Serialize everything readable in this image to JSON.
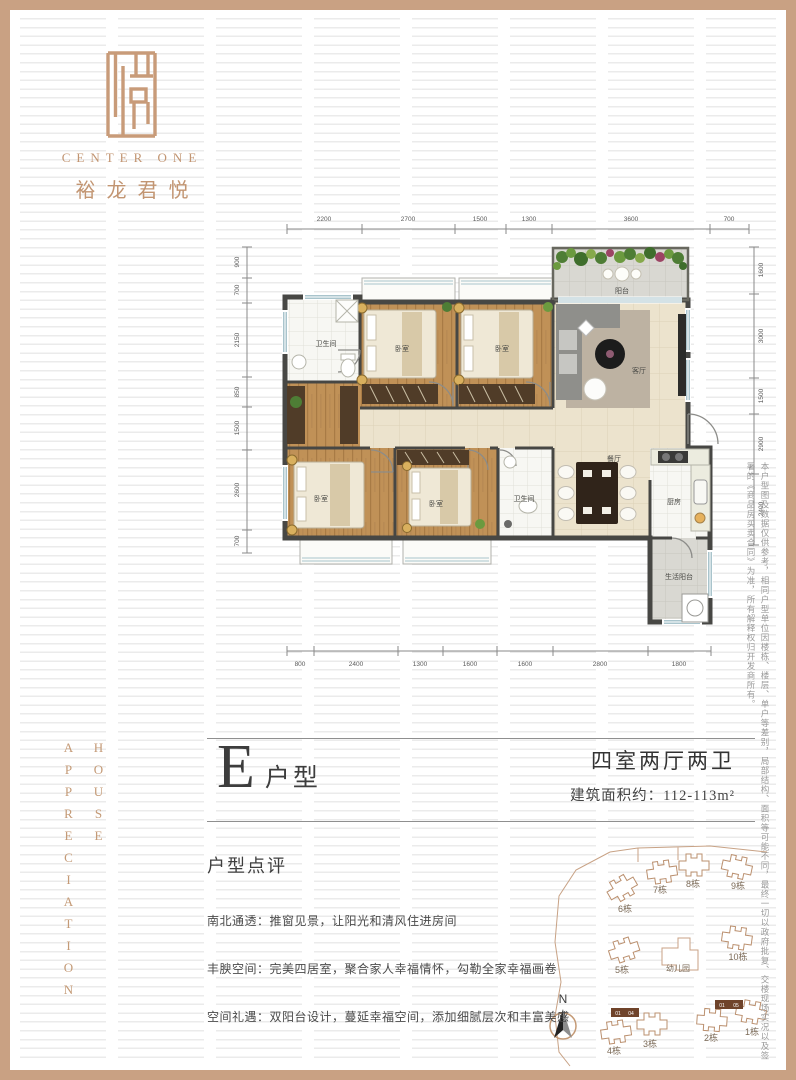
{
  "brand": {
    "name_en": "CENTER ONE",
    "name_cn": "裕龙君悦"
  },
  "side_left": {
    "word1": "HOUSE",
    "word2": "APPRECIATION"
  },
  "side_right": {
    "disclaimer": "本户型图及数据仅供参考，相同户型单位因楼栋、楼层、单户等差别，局部结构、面积等可能不同，最终一切以政府批复、交楼现场实况以及签署的《商品房买卖合同》为准，所有解释权归开发商所有。"
  },
  "unit": {
    "letter": "E",
    "suffix": "户型",
    "config": "四室两厅两卫",
    "area": "建筑面积约：112-113m²"
  },
  "review": {
    "heading": "户型点评",
    "items": [
      "南北通透：推窗见景，让阳光和清风住进房间",
      "丰腴空间：完美四居室，聚合家人幸福情怀，勾勒全家幸福画卷",
      "空间礼遇：双阳台设计，蔓延幸福空间，添加细腻层次和丰富美感"
    ]
  },
  "floorplan": {
    "rooms": [
      "阳台",
      "客厅",
      "卧室",
      "卧室",
      "卫生间",
      "卧室",
      "卧室",
      "卫生间",
      "餐厅",
      "厨房",
      "生活阳台"
    ],
    "dims": {
      "top": [
        "2200",
        "2700",
        "1500",
        "1300",
        "3600",
        "700"
      ],
      "bottom": [
        "800",
        "2400",
        "1300",
        "1600",
        "1600",
        "2800",
        "1800"
      ],
      "left": [
        "900",
        "700",
        "2150",
        "850",
        "1500",
        "2600",
        "700"
      ],
      "right": [
        "1600",
        "3000",
        "1500",
        "2900",
        "2400"
      ]
    }
  },
  "site": {
    "north": "N",
    "kindergarten": "幼儿园",
    "buildings": [
      "6栋",
      "7栋",
      "8栋",
      "9栋",
      "10栋",
      "5栋",
      "4栋",
      "3栋",
      "2栋",
      "1栋"
    ],
    "units": [
      "01",
      "04",
      "01",
      "05"
    ]
  },
  "colors": {
    "accent_tan": "#c9a183",
    "wall": "#474744",
    "wood_floor": "#c09157",
    "highlight_unit": "#6f432a"
  }
}
